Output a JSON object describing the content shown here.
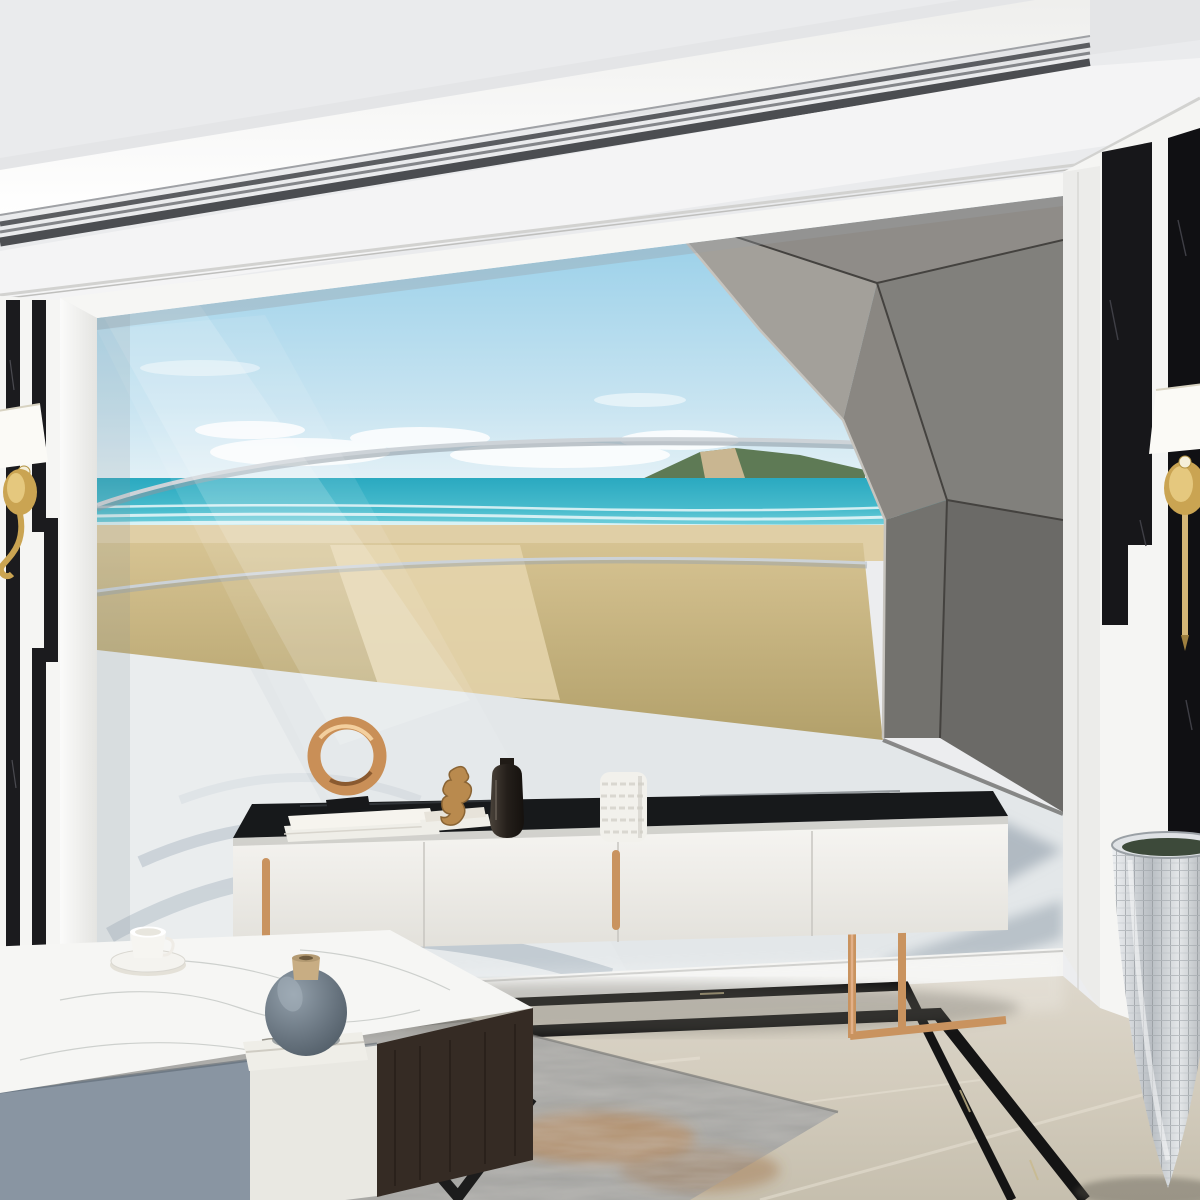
{
  "meta": {
    "title": "Modern living room with 3D beach colonnade wall mural",
    "width": 1200,
    "height": 1200
  },
  "palette": {
    "ceiling": "#eaebed",
    "ceiling_band": "#f4f4f5",
    "trim_dark": "#4b4d51",
    "cornice": "#d2d2d0",
    "wall_white": "#f5f5f3",
    "marble_black": "#17171a",
    "sky_top": "#8ecbe7",
    "sky_low": "#e6f2f7",
    "cloud": "#ffffff",
    "sea_deep": "#2aa9c0",
    "sea_light": "#63cbd8",
    "foam": "#f4fbfc",
    "sand": "#e0cfa6",
    "sand_dark": "#d2bd8f",
    "headland": "#5e7a55",
    "cliff": "#c9b691",
    "fin_light": "#f1f3f4",
    "fin_dark": "#c3cad0",
    "fin_edge": "#9aa3ab",
    "fan_a": "#f3f4f5",
    "fan_b": "#e7e9ea",
    "concrete_a": "#a3a09a",
    "concrete_b": "#8f8c88",
    "concrete_c": "#8a8782",
    "concrete_d": "#81807c",
    "concrete_e": "#73726e",
    "concrete_f": "#6b6a67",
    "seam": "#44423f",
    "interior_floor": "#e3e7e9",
    "shadow_blue": "#5f6b76",
    "arc_shadow": "#8b9dac",
    "post_wood": "#cbb98f",
    "rope": "#cfc3a0",
    "console_white": "#f2f1ee",
    "console_top": "#17191b",
    "rose_gold": "#c9935f",
    "rose_gold_light": "#e2b088",
    "table_marble": "#f6f6f4",
    "drawer_blue": "#8995a2",
    "drawer_white": "#e9e8e2",
    "wood_side": "#352b24",
    "leg_black": "#1c1c1c",
    "floor": "#d8d2c6",
    "floor_dark": "#c9c2b3",
    "border_black": "#141414",
    "rug_base": "#a3a3a0",
    "rug_rust": "#b0662e",
    "rug_rust2": "#c07a38",
    "gold": "#d4b678",
    "gold_light": "#f0dfae",
    "gold_dark": "#9e7f3f",
    "pot_silver": "#c9cdd2",
    "orchid_blue": "#5f9fd8",
    "orchid_core": "#2f6fae",
    "cactus": "#9ab95e",
    "palm": "#4f8040",
    "palm_light": "#6a9a50",
    "cream_flower": "#e9e6d4",
    "vase_blue_hi": "#93a0ab",
    "vase_blue": "#66727d",
    "vase_cork": "#c8ad83",
    "book_white": "#efeee8",
    "bottle_dark": "#2e2a26",
    "white_vase": "#f2f1ec",
    "dried_flower": "#a8a5a0"
  },
  "ceiling": {
    "downlights": [
      [
        208,
        263,
        16,
        7
      ],
      [
        449,
        230,
        15,
        7
      ],
      [
        772,
        184,
        13,
        6
      ],
      [
        1163,
        125,
        18,
        8
      ]
    ],
    "cove_light": true
  },
  "chandelier": {
    "finish": "polished gold",
    "shade_style": "white pleated cone",
    "hub": [
      198,
      118
    ],
    "shades": [
      [
        55,
        -10
      ],
      [
        168,
        -14
      ],
      [
        272,
        6
      ],
      [
        348,
        46
      ],
      [
        366,
        116
      ],
      [
        12,
        104
      ],
      [
        -6,
        168
      ],
      [
        98,
        188
      ],
      [
        206,
        206
      ],
      [
        304,
        170
      ]
    ]
  },
  "sconces": {
    "left": {
      "x": 20,
      "shade_y": 408
    },
    "right": {
      "x": 1185,
      "shade_y": 385
    }
  },
  "mural": {
    "description": "3D mural: curved white louver colonnade opening to a beach, faceted concrete arch on right",
    "fins": {
      "count": 28,
      "x0": 100,
      "s0": 37,
      "s1": 18
    },
    "horizon_y": 480,
    "sea_top": 480,
    "sand_top": 525,
    "grass_top": 543,
    "posts": [
      [
        247,
        558,
        9,
        62
      ],
      [
        447,
        550,
        10,
        70
      ],
      [
        647,
        540,
        9,
        62
      ],
      [
        800,
        505,
        46,
        235
      ]
    ],
    "rope_spans": [
      [
        251,
        562,
        449,
        554,
        56
      ],
      [
        451,
        554,
        649,
        544,
        46
      ],
      [
        651,
        544,
        806,
        562,
        26
      ]
    ],
    "grass": {
      "count": 175,
      "x_min": 112,
      "x_max": 868
    }
  },
  "furniture": {
    "tv_console": {
      "doors": 4,
      "handles": 2,
      "finish": "white lacquer, black stone top, rose-gold legs",
      "items": [
        "rose-gold ring sculpture on books",
        "bronze seahorse figurine on books",
        "dark glass bottle vase",
        "white textured vase with dried flowers"
      ]
    },
    "coffee_table": {
      "finish": "white marble top, blue-gray and white drawers, dark wood side, black metal legs",
      "items": [
        "white teacup with saucer",
        "blue-gray round vase with cork lid on white book"
      ]
    },
    "rug": "distressed gray with rust-orange patches",
    "planter": {
      "vessel": "tall silver mosaic vase",
      "plants": [
        "palm fronds",
        "cream feather flowers",
        "blue orchids",
        "green barrel cacti"
      ]
    }
  },
  "plants": {
    "palm_blades": 13,
    "orchid_blossom_r": 9,
    "stems": [
      [
        [
          1118,
          742
        ],
        [
          1098,
          790
        ],
        [
          1075,
          822
        ],
        [
          1066,
          860
        ]
      ],
      [
        [
          1130,
          746
        ],
        [
          1122,
          800
        ],
        [
          1102,
          842
        ],
        [
          1092,
          874
        ]
      ]
    ],
    "cacti": [
      [
        1152,
        797,
        24
      ],
      [
        1193,
        789,
        21
      ]
    ]
  }
}
